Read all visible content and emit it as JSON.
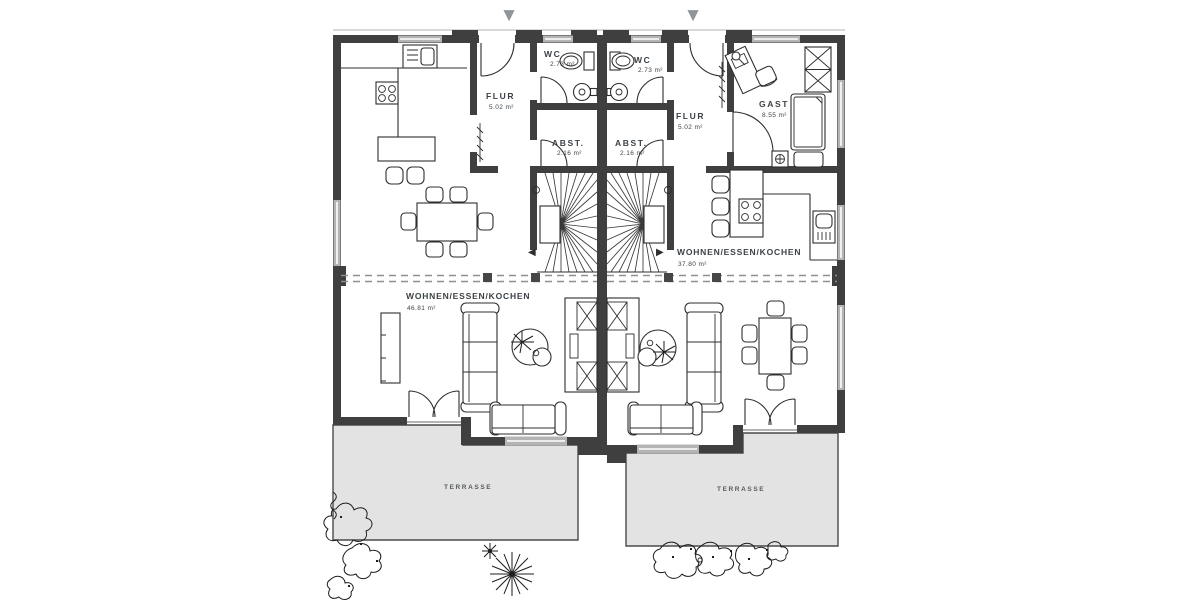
{
  "colors": {
    "wall": "#3f3f3f",
    "window_band": "#b4b4b4",
    "terrace_fill": "#e3e3e3",
    "dashed": "#8f8f8f",
    "arrow": "#8e959b",
    "text": "#3c4247"
  },
  "icons": {
    "entrance_arrow": "▼",
    "stair_arrow_left": "◀",
    "stair_arrow_right": "▶"
  },
  "plan": {
    "units": {
      "left": {
        "rooms": [
          {
            "label": "FLUR",
            "area": "5.02 m²"
          },
          {
            "label": "WC",
            "area": "2.73 m²"
          },
          {
            "label": "ABST.",
            "area": "2.16 m²"
          },
          {
            "label": "WOHNEN/ESSEN/KOCHEN",
            "area": "46.81 m²"
          }
        ],
        "terrace": "TERRASSE"
      },
      "right": {
        "rooms": [
          {
            "label": "WC",
            "area": "2.73 m²"
          },
          {
            "label": "ABST.",
            "area": "2.16 m²"
          },
          {
            "label": "FLUR",
            "area": "5.02 m²"
          },
          {
            "label": "GAST",
            "area": "8.55 m²"
          },
          {
            "label": "WOHNEN/ESSEN/KOCHEN",
            "area": "37.80 m²"
          }
        ],
        "terrace": "TERRASSE"
      }
    }
  }
}
